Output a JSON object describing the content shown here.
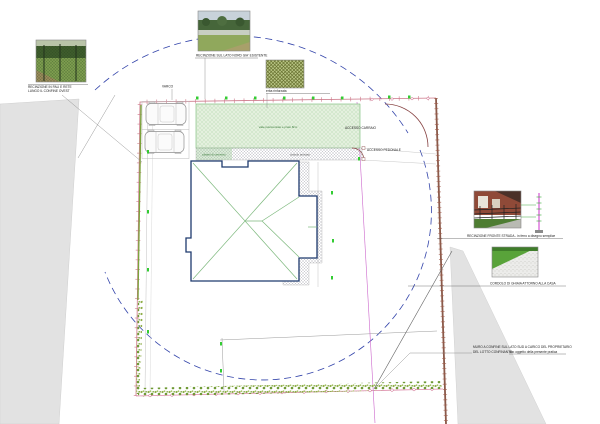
{
  "captions": {
    "photo_west_1": "RECINZIONE IN PALI E RETE",
    "photo_west_2": "LUNGO IL CONFINE OVEST",
    "photo_north": "RECINZIONE SUL LATO NORD GIA' ESISTENTE",
    "swatch": "erba rinforzata",
    "photo_street": "RECINZIONE FRONTE STRADA - in ferro a disegno semplice",
    "photo_gravel": "CORDOLO DI GHIAIA ATTORNO ALLA CASA",
    "wall_note_1": "MURO A CONFINE SUL LATO SUD A CARICO DEL PROPRIETARIO",
    "wall_note_2": "DEL LOTTO CONFINANTE -",
    "wall_note_2_underlined": "non oggetto della presente pratica"
  },
  "labels": {
    "varco": "VARCO",
    "court": "viale pavimentato e prato 8cm",
    "pillars": "pilastri di cemento",
    "cobble": "ciottolo anticato",
    "gate_vehicle": "ACCESSO CARRAIO",
    "gate_pedestrian": "ACCESSO PEDONALE"
  },
  "colors": {
    "boundary_pink": "#cc7788",
    "boundary_wall": "#8a5a4a",
    "radius_dash_blue": "#3344aa",
    "dimension_green": "#33cc33",
    "court_green_fill": "#e4f0de",
    "road_gray": "#e2e2e2"
  }
}
